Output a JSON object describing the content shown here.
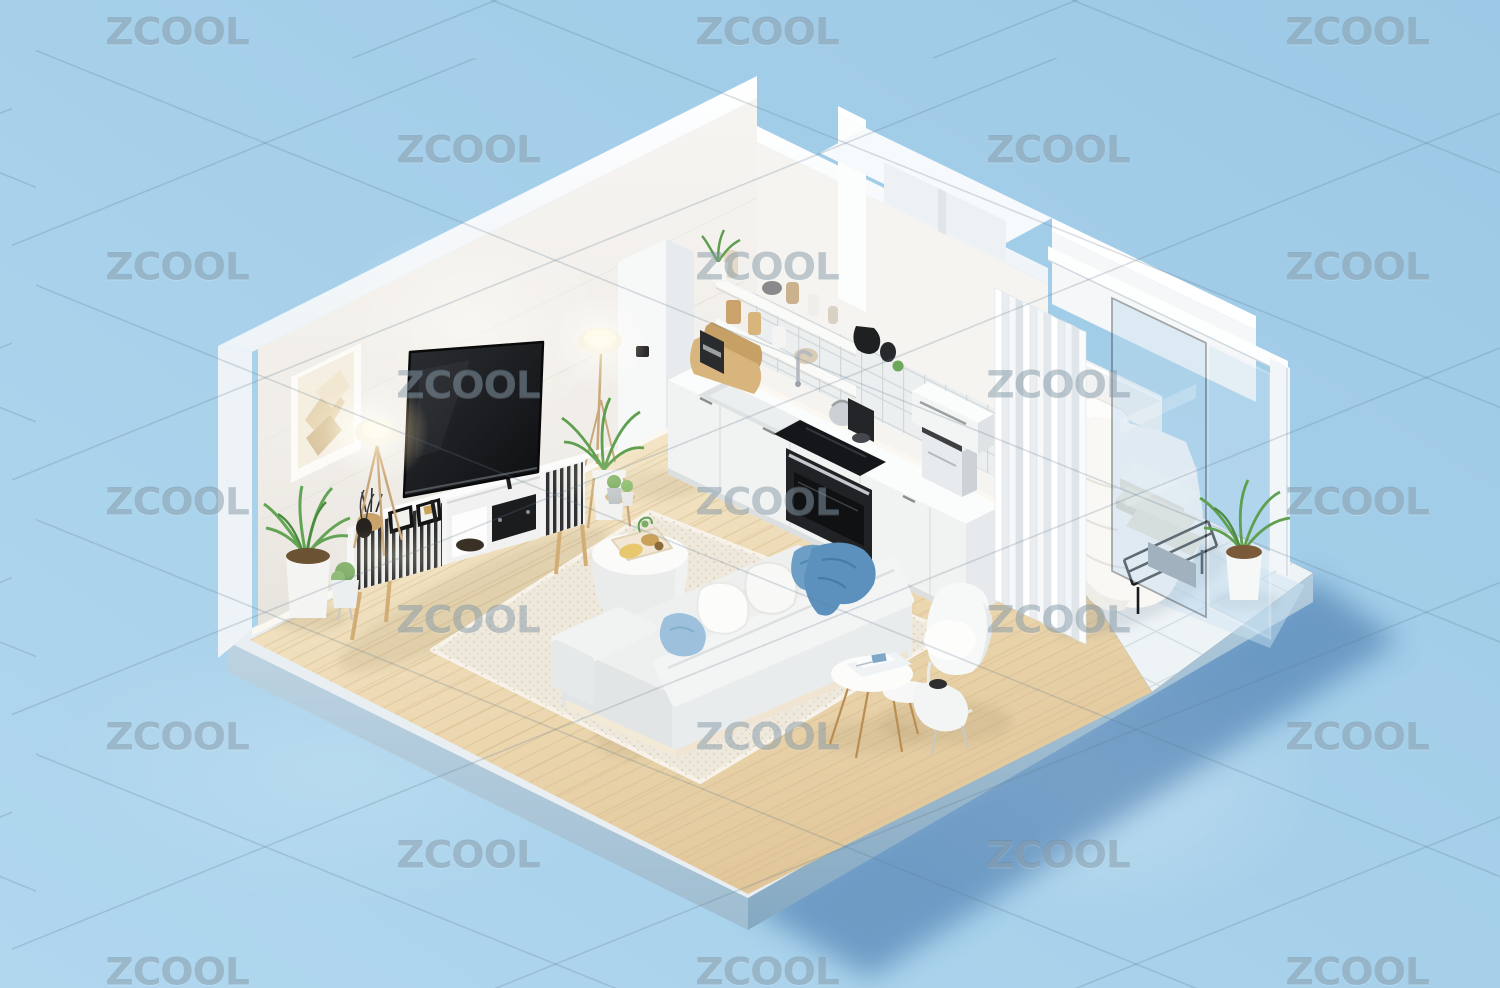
{
  "image": {
    "kind": "isometric 3D render",
    "subject": "Open-plan studio apartment cutaway: living room with TV and sofa, white kitchen, bedroom nook with glass balcony wall, on a light blue backdrop",
    "background_color": "#a6d0ea"
  },
  "watermark": {
    "text": "ZCOOL",
    "color": "rgba(108,132,148,0.42)",
    "font_size_px": 37,
    "rows": [
      {
        "y": 32,
        "xs": [
          177,
          767,
          1357
        ]
      },
      {
        "y": 150,
        "xs": [
          468,
          1058
        ]
      },
      {
        "y": 267,
        "xs": [
          177,
          767,
          1357
        ]
      },
      {
        "y": 385,
        "xs": [
          468,
          1058
        ]
      },
      {
        "y": 502,
        "xs": [
          177,
          767,
          1357
        ]
      },
      {
        "y": 620,
        "xs": [
          468,
          1058
        ]
      },
      {
        "y": 737,
        "xs": [
          177,
          767,
          1357
        ]
      },
      {
        "y": 855,
        "xs": [
          468,
          1058
        ]
      },
      {
        "y": 972,
        "xs": [
          177,
          767,
          1357
        ]
      }
    ]
  },
  "palette": {
    "background": "#a6d0ea",
    "slab_side_left": "#a9c4d5",
    "slab_side_right": "#9cb9cd",
    "ground_shadow": "#3f6fa4",
    "wood_floor": "#ead7b3",
    "wall_white": "#f3f1ee",
    "tile_floor": "#eef3f6",
    "warm_light": "#ffe2a8",
    "tv_screen": "#141619",
    "sofa_fabric": "#eff1f1",
    "pillow_blue": "#6d9ec6",
    "throw_blue": "#5d91bd",
    "plant_green": "#63a455",
    "wood_leg": "#d2ad76"
  },
  "objects": [
    "left wall with abstract art frame",
    "two glowing floor lamps",
    "flat screen TV on slatted media console",
    "audio receiver and game console on shelf",
    "potted palm plants",
    "white refrigerator",
    "kitchen counter with sink, cooktop, oven, coffee machine and microwave",
    "open shelves with dishes",
    "tiled backsplash",
    "round white coffee table with snack tray",
    "cream shag rug",
    "white sofa with blue pillows and throw",
    "white lounge chair with ottoman",
    "nesting side tables with magazines",
    "bed with white duvet, folded towels and black metal frame",
    "white pleated curtain",
    "glass balcony wall with white rail and post",
    "potted plant on white tile balcony floor"
  ]
}
